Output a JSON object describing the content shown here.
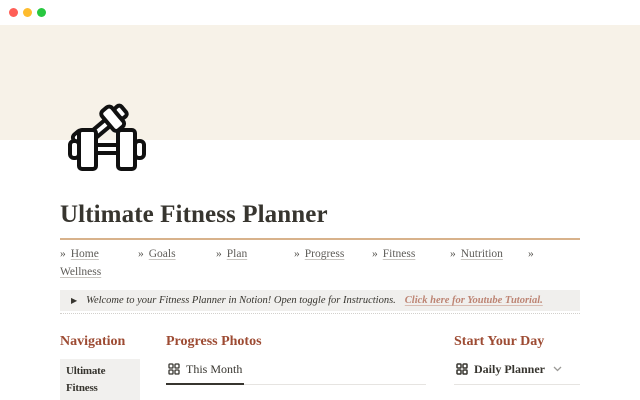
{
  "window": {
    "controls": [
      "close",
      "minimize",
      "zoom"
    ]
  },
  "banner": {
    "icon": "crossed-dumbbells"
  },
  "page": {
    "title": "Ultimate Fitness Planner"
  },
  "nav": {
    "separator": "»",
    "items": [
      "Home",
      "Goals",
      "Plan",
      "Progress",
      "Fitness",
      "Nutrition",
      "Wellness"
    ]
  },
  "callout": {
    "toggle_icon": "▶",
    "text": "Welcome to your Fitness Planner in Notion! Open toggle for Instructions.",
    "link_text": "Click here for Youtube Tutorial."
  },
  "columns": {
    "navigation": {
      "heading": "Navigation",
      "item": "Ultimate Fitness Planner"
    },
    "progress_photos": {
      "heading": "Progress Photos",
      "active_tab": "This Month"
    },
    "start_your_day": {
      "heading": "Start Your Day",
      "view": "Daily Planner"
    }
  },
  "colors": {
    "banner": "#f7f2e8",
    "divider": "#d8b28b",
    "section_heading": "#9d4b33",
    "callout_link": "#bd8473",
    "callout_bg": "#f0efed",
    "traffic_lights": [
      "#ff5f57",
      "#febc2e",
      "#28c840"
    ]
  }
}
